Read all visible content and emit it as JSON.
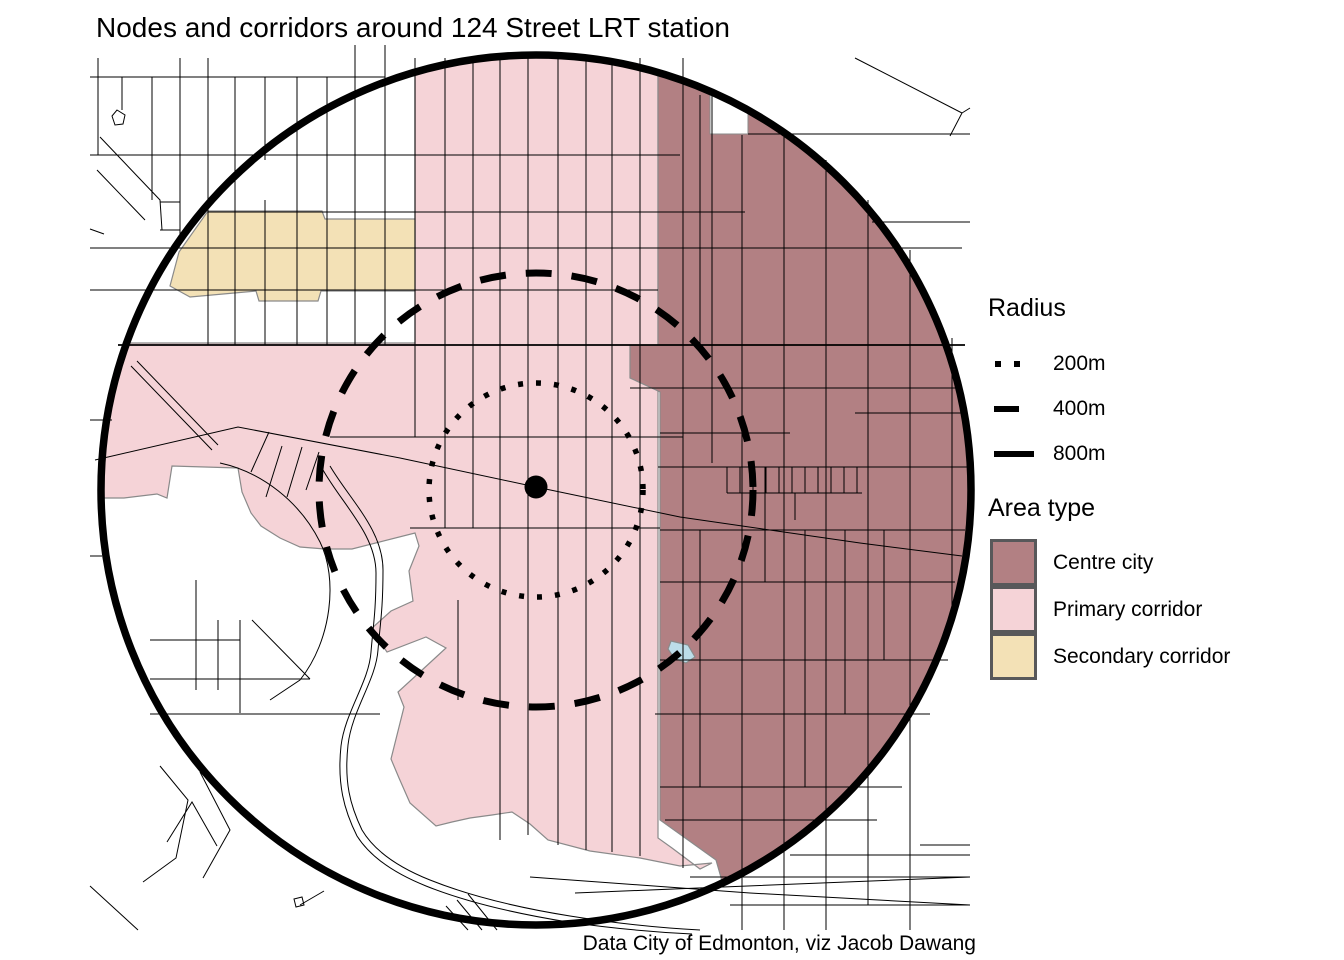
{
  "title": "Nodes and corridors around 124 Street LRT station",
  "caption": "Data City of Edmonton, viz Jacob Dawang",
  "legend_radius": {
    "title": "Radius",
    "items": [
      {
        "label": "200m",
        "style": "dotted"
      },
      {
        "label": "400m",
        "style": "dashed"
      },
      {
        "label": "800m",
        "style": "solid"
      }
    ]
  },
  "legend_area": {
    "title": "Area type",
    "items": [
      {
        "label": "Centre city",
        "color": "#b28083"
      },
      {
        "label": "Primary corridor",
        "color": "#f5d3d7"
      },
      {
        "label": "Secondary corridor",
        "color": "#f3e1b6"
      }
    ]
  },
  "colors": {
    "water": "#bcdde9",
    "area_outline": "#8a8a8a",
    "street": "#000000",
    "ring": "#000000",
    "background": "#ffffff"
  },
  "chart_data": {
    "type": "map",
    "title": "Nodes and corridors around 124 Street LRT station",
    "station": "124 Street LRT station",
    "rings": [
      {
        "radius_m": 200,
        "line_style": "dotted"
      },
      {
        "radius_m": 400,
        "line_style": "dashed"
      },
      {
        "radius_m": 800,
        "line_style": "solid"
      }
    ],
    "area_types": [
      {
        "name": "Centre city",
        "color": "#b28083",
        "position": "east of station, inside 800m ring"
      },
      {
        "name": "Primary corridor",
        "color": "#f5d3d7",
        "position": "central north-south strip plus west arm around station"
      },
      {
        "name": "Secondary corridor",
        "color": "#f3e1b6",
        "position": "small strip northwest of station"
      }
    ],
    "legend_position": "right",
    "caption": "Data City of Edmonton, viz Jacob Dawang"
  }
}
